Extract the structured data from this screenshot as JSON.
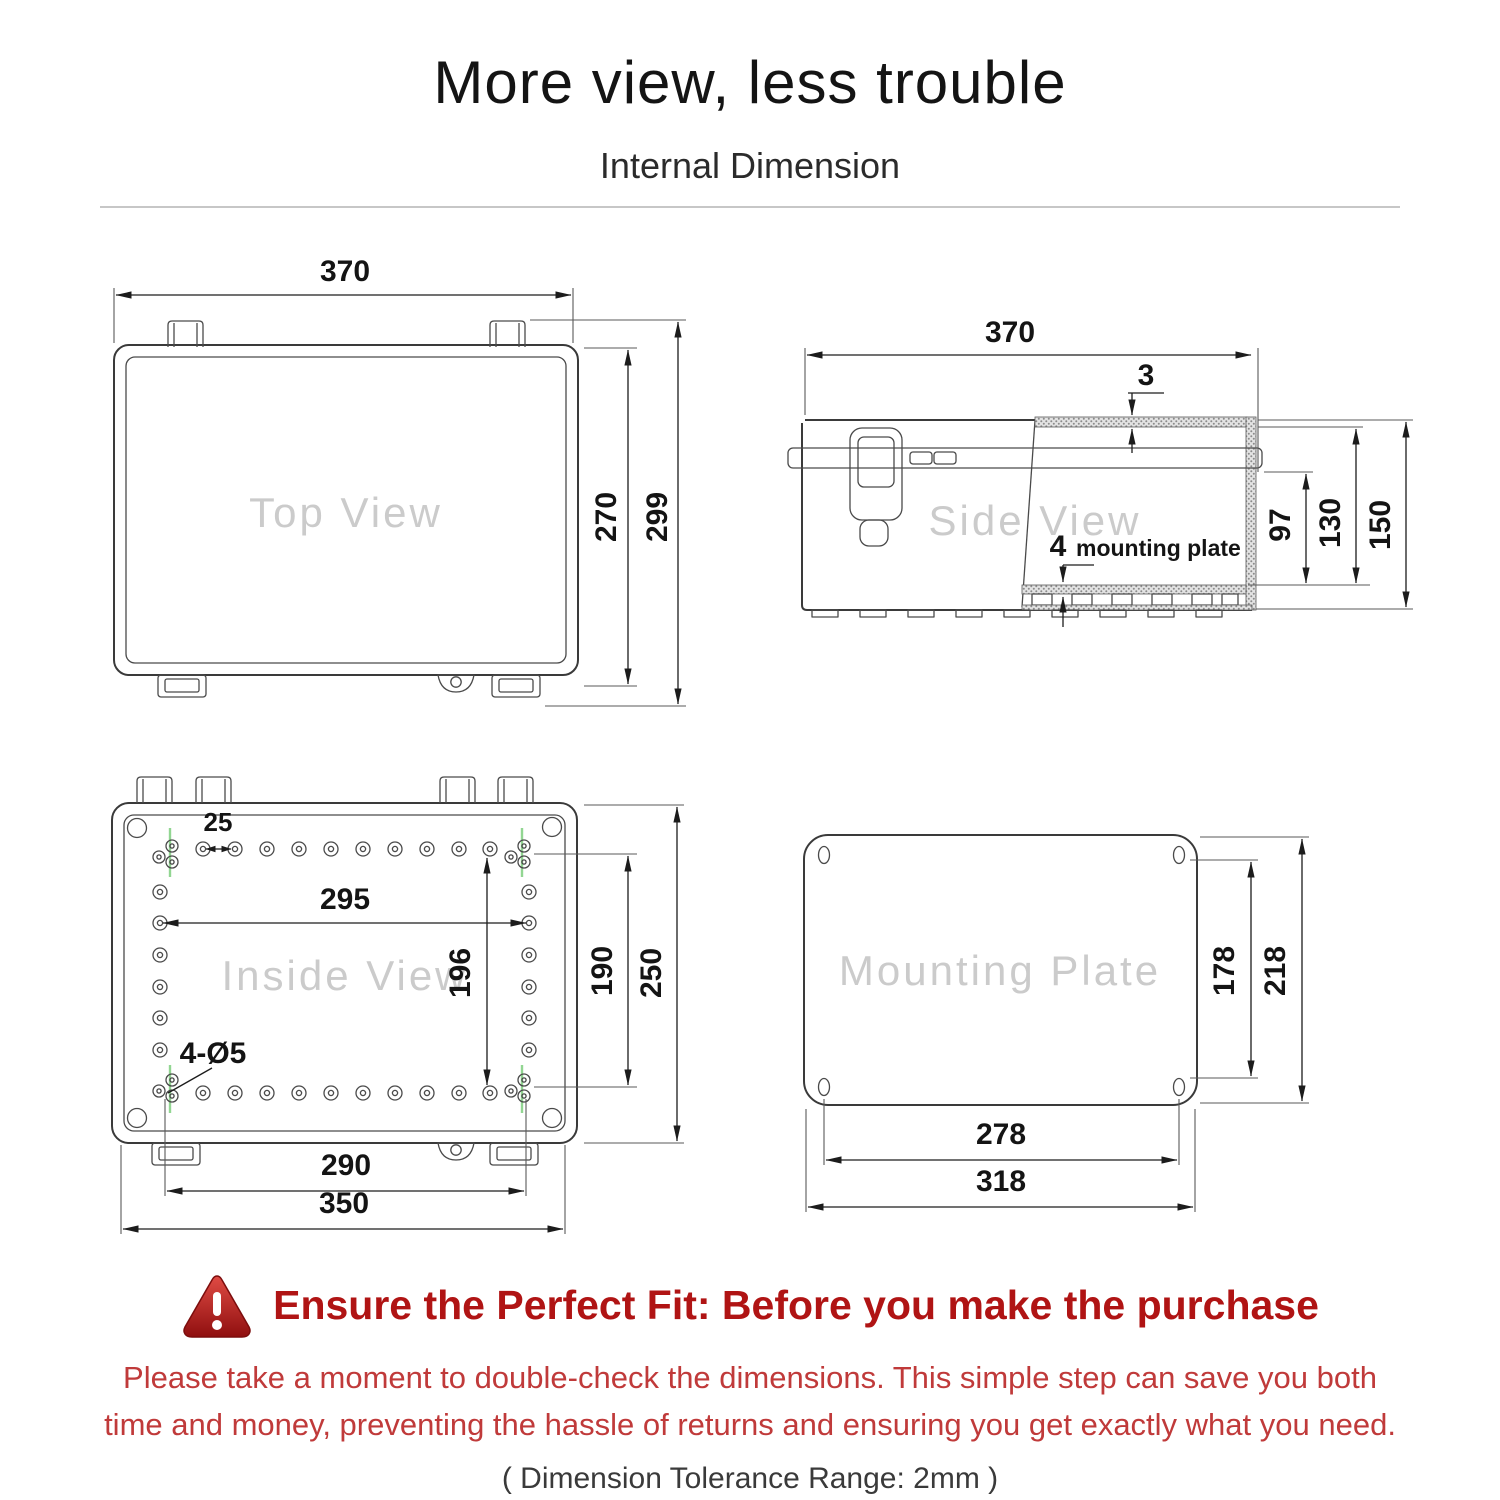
{
  "header": {
    "title": "More view, less trouble",
    "subtitle": "Internal Dimension"
  },
  "views": {
    "top": {
      "watermark": "Top View",
      "dims": {
        "width": "370",
        "inner_height": "270",
        "outer_height": "299"
      }
    },
    "side": {
      "watermark": "Side View",
      "dims": {
        "width": "370",
        "lid_thickness": "3",
        "depth_below_lid": "97",
        "inner_depth": "130",
        "outer_depth": "150",
        "plate_thickness": "4"
      },
      "plate_label": "mounting plate"
    },
    "inside": {
      "watermark": "Inside View",
      "dims": {
        "hole_pitch": "25",
        "hole_span_width": "295",
        "hole_span_height": "196",
        "mount_hole_height": "190",
        "height": "250",
        "mount_hole_width": "290",
        "width": "350",
        "mount_holes": "4-Ø5"
      }
    },
    "plate": {
      "watermark": "Mounting Plate",
      "dims": {
        "hole_height": "178",
        "height": "218",
        "hole_width": "278",
        "width": "318"
      }
    }
  },
  "warning": {
    "heading": "Ensure the Perfect Fit: Before you make the purchase",
    "body_line1": "Please take a moment to double-check the dimensions. This simple step can save you both",
    "body_line2": "time and money, preventing the hassle of returns and ensuring you get exactly what you need.",
    "tolerance": "( Dimension Tolerance Range: 2mm )"
  },
  "colors": {
    "heading_red": "#b01414",
    "body_red": "#c03a3a",
    "drawing_line": "#3a3a3a",
    "watermark_gray": "#cbcbcb",
    "marker_green": "#92d692"
  }
}
